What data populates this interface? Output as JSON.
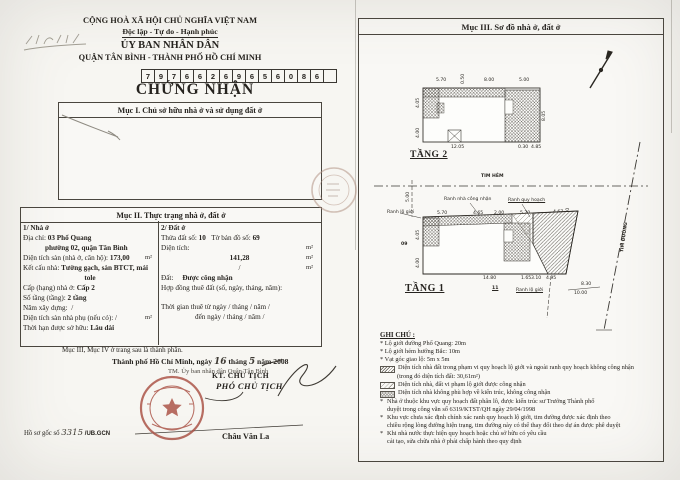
{
  "left_page": {
    "header": {
      "country": "CỘNG HOÀ XÃ HỘI CHỦ NGHĨA VIỆT NAM",
      "motto": "Độc lập - Tự do - Hạnh phúc",
      "issuer": "ỦY BAN NHÂN DÂN",
      "issuer_locality": "QUẬN TÂN BÌNH - THÀNH PHỐ HỒ CHÍ MINH",
      "code_digits": [
        "7",
        "9",
        "7",
        "6",
        "6",
        "2",
        "6",
        "9",
        "6",
        "5",
        "6",
        "0",
        "8",
        "6",
        ""
      ],
      "title": "CHỨNG NHẬN"
    },
    "section1": {
      "heading": "Mục I. Chủ sở hữu nhà ở và sử dụng đất ở"
    },
    "section2": {
      "heading": "Mục II. Thực trạng nhà ở, đất ở",
      "house": {
        "heading": "1/ Nhà ở",
        "address_label": "Địa chỉ:",
        "address_value": "03 Phổ Quang",
        "address_value2": "phường 02, quận Tân Bình",
        "floor_area_label": "Diện tích sàn (nhà ở, căn hộ):",
        "floor_area_value": "173,00",
        "floor_area_unit": "m²",
        "structure_label": "Kết cấu nhà:",
        "structure_value": "Tường gạch, sàn BTCT, mái",
        "structure_value2": "tole",
        "grade_label": "Cấp (hạng) nhà ở:",
        "grade_value": "Cấp 2",
        "floors_label": "Số tầng (tầng):",
        "floors_value": "2 tầng",
        "year_label": "Năm xây dựng:",
        "year_value": "/",
        "aux_area_label": "Diện tích sàn nhà phụ (nếu có):",
        "aux_area_value": "/",
        "aux_area_unit": "m²",
        "tenure_label": "Thời hạn được sở hữu:",
        "tenure_value": "Lâu dài"
      },
      "land": {
        "heading": "2/ Đất ở",
        "parcel_label": "Thửa đất số:",
        "parcel_value": "10",
        "map_label": "Tờ bản đồ số:",
        "map_value": "69",
        "area_label": "Diện tích:",
        "unit": "m²",
        "area_value": "141,28",
        "area_shared_value": "/",
        "status_label": "Đất:",
        "status_value": "Được công nhận",
        "lease_label": "Hợp đồng thuê đất (số, ngày, tháng, năm):",
        "lease_time1": "Thời gian thuê từ ngày  /  tháng  /  năm  /",
        "lease_time2": "đến ngày  /  tháng  /  năm  /"
      }
    },
    "footer_note": "Mục III, Mục IV ở trang sau là thành phần.",
    "signing": {
      "place_date_prefix": "Thành phố Hồ Chí Minh, ngày",
      "day": "16",
      "month_word": "tháng",
      "month": "5",
      "year_suffix": "năm 2008",
      "on_behalf": "TM. Ủy ban nhân dân Quận Tân Bình",
      "kt_line": "KT. CHỦ TỊCH",
      "deputy_title": "PHÓ CHỦ TỊCH",
      "signer_name": "Châu Văn La"
    },
    "dossier": {
      "label": "Hồ sơ gốc số",
      "number": "3315",
      "suffix": "/UB.GCN"
    }
  },
  "right_page": {
    "heading": "Mục III. Sơ đồ nhà ở, đất ở",
    "floor2": {
      "label": "TẦNG 2",
      "dims": [
        {
          "t": "5.70",
          "x": 436,
          "y": 78
        },
        {
          "t": "0.50",
          "x": 461,
          "y": 84,
          "r": -90
        },
        {
          "t": "8.00",
          "x": 484,
          "y": 78
        },
        {
          "t": "5.00",
          "x": 519,
          "y": 78
        },
        {
          "t": "4.05",
          "x": 416,
          "y": 108,
          "r": -90
        },
        {
          "t": "0.50",
          "x": 424,
          "y": 110
        },
        {
          "t": "4.00",
          "x": 416,
          "y": 138,
          "r": -90
        },
        {
          "t": "10.85",
          "x": 466,
          "y": 90
        },
        {
          "t": "3.00",
          "x": 499,
          "y": 112,
          "r": -90
        },
        {
          "t": "1.00",
          "x": 501,
          "y": 128,
          "r": -90
        },
        {
          "t": "8.05",
          "x": 542,
          "y": 121,
          "r": -90
        },
        {
          "t": "12.05",
          "x": 451,
          "y": 145
        },
        {
          "t": "0.30",
          "x": 518,
          "y": 145
        },
        {
          "t": "4.85",
          "x": 531,
          "y": 145
        }
      ]
    },
    "floor1": {
      "label": "TẦNG 1",
      "alley_axis": "TIM HẺM",
      "road_axis": "TIM ĐƯỜNG",
      "area_value": "179,99 m2",
      "lot_number": "10",
      "dims": [
        {
          "t": "TIM HẺM",
          "x": 481,
          "y": 174,
          "b": 1
        },
        {
          "t": "5.00",
          "x": 406,
          "y": 202,
          "r": -90
        },
        {
          "t": "Ranh nhà công nhận",
          "x": 444,
          "y": 197
        },
        {
          "t": "Ranh quy hoạch",
          "x": 508,
          "y": 198,
          "u": 1
        },
        {
          "t": "Ranh lộ giới",
          "x": 387,
          "y": 210
        },
        {
          "t": "5.70",
          "x": 437,
          "y": 211
        },
        {
          "t": "4.65",
          "x": 473,
          "y": 211
        },
        {
          "t": "2.00",
          "x": 494,
          "y": 211
        },
        {
          "t": "5.70",
          "x": 520,
          "y": 211
        },
        {
          "t": "4.67",
          "x": 553,
          "y": 210
        },
        {
          "t": "0.50",
          "x": 566,
          "y": 218,
          "r": -90
        },
        {
          "t": "10.00",
          "x": 470,
          "y": 221
        },
        {
          "t": "4.05",
          "x": 416,
          "y": 240,
          "r": -90
        },
        {
          "t": "3.70",
          "x": 428,
          "y": 242,
          "r": -90
        },
        {
          "t": "09",
          "x": 401,
          "y": 242,
          "b": 1
        },
        {
          "t": "4.00",
          "x": 416,
          "y": 268,
          "r": -90
        },
        {
          "t": "10",
          "x": 488,
          "y": 240,
          "b": 1
        },
        {
          "t": "179,99 m2",
          "x": 479,
          "y": 248
        },
        {
          "t": "3.80",
          "x": 526,
          "y": 241,
          "r": -90
        },
        {
          "t": "14.80",
          "x": 483,
          "y": 276
        },
        {
          "t": "1.65",
          "x": 521,
          "y": 276
        },
        {
          "t": "3.10",
          "x": 531,
          "y": 276
        },
        {
          "t": "4.95",
          "x": 546,
          "y": 276
        },
        {
          "t": "11",
          "x": 492,
          "y": 286,
          "b": 1,
          "u": 1
        },
        {
          "t": "Ranh lộ giới",
          "x": 516,
          "y": 288,
          "u": 1
        },
        {
          "t": "8.30",
          "x": 581,
          "y": 282
        },
        {
          "t": "10.00",
          "x": 574,
          "y": 291
        },
        {
          "t": "TIM ĐƯỜNG",
          "x": 620,
          "y": 252,
          "r": -82,
          "b": 1
        }
      ]
    },
    "notes": {
      "title": "GHI CHÚ :",
      "bullets": [
        "* Lộ giới đường Phổ Quang: 20m",
        "* Lộ giới hẻm hướng Bắc: 10m",
        "* Vạt góc giao lộ: 5m x 5m"
      ],
      "legend": [
        {
          "text": "Diện tích nhà đất trong phạm vi quy hoạch lộ giới và ngoài ranh quy hoạch không công nhận",
          "text2": "(trong đó diện tích đất: 30,61m²)"
        },
        {
          "text": "Diện tích nhà, đất vi phạm lộ giới được công nhận"
        },
        {
          "text": "Diện tích nhà không phù hợp về kiến trúc, không công nhận"
        }
      ],
      "paragraphs": [
        {
          "l1": "Nhà ở thuộc khu vực quy hoạch đất phân lô, được kiến trúc sư Trưởng Thành phố",
          "l2": "duyệt trong công văn số 6319/KTST/QH ngày 29/04/1998"
        },
        {
          "l1": "Khu vực chưa xác định chính xác ranh quy hoạch lộ giới, tim đường được xác định theo",
          "l2": "chiều rộng lòng đường hiện trạng, tim đường này có thể thay đổi theo dự án được phê duyệt"
        },
        {
          "l1": "Khi nhà nước thực hiện quy hoạch hoặc chủ sở hữu có yêu cầu",
          "l2": "cải tạo, sửa chữa nhà ở phải chấp hành theo quy định"
        }
      ]
    }
  }
}
